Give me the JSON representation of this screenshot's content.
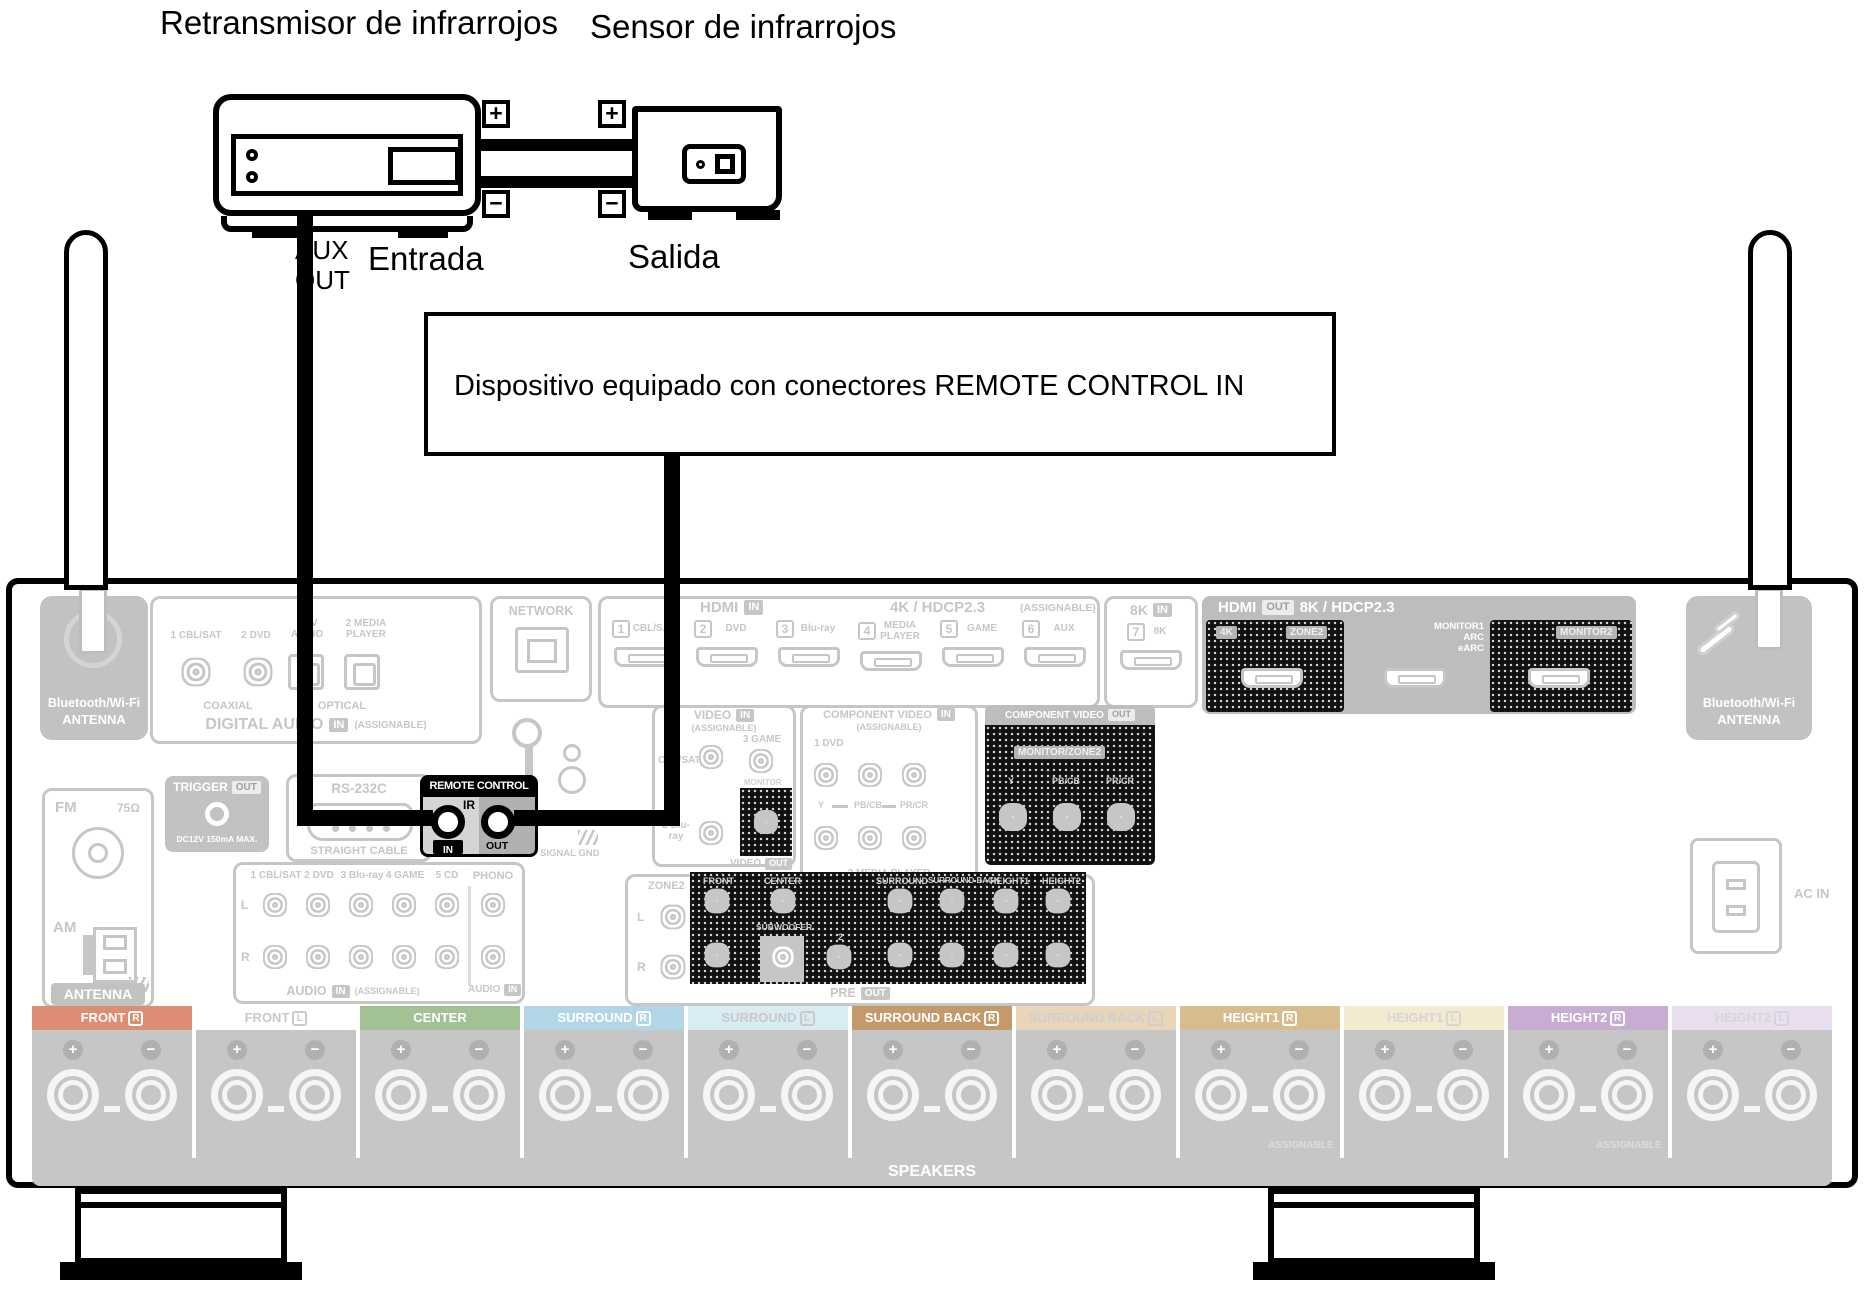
{
  "glyphs": {
    "plus": "+",
    "minus": "−"
  },
  "top": {
    "retransmitter_label": "Retransmisor de infrarrojos",
    "sensor_label": "Sensor de infrarrojos",
    "aux_line1": "AUX",
    "aux_line2": "OUT",
    "entrada": "Entrada",
    "salida": "Salida"
  },
  "device_box": {
    "text": "Dispositivo equipado con conectores REMOTE CONTROL IN"
  },
  "rear": {
    "bt_left": {
      "line1": "Bluetooth/Wi-Fi",
      "line2": "ANTENNA"
    },
    "bt_right": {
      "line1": "Bluetooth/Wi-Fi",
      "line2": "ANTENNA"
    },
    "digital_audio": {
      "p1": "1 CBL/SAT",
      "p2": "2 DVD",
      "p3": "1 TV AUDIO",
      "p4": "2 MEDIA PLAYER",
      "coaxial": "COAXIAL",
      "optical": "OPTICAL",
      "title": "DIGITAL AUDIO",
      "badge": "IN",
      "assignable": "(ASSIGNABLE)"
    },
    "network": {
      "title": "NETWORK"
    },
    "hdmi_in": {
      "title": "HDMI",
      "badge": "IN",
      "subtitle": "4K / HDCP2.3",
      "assignable": "(ASSIGNABLE)",
      "ports": [
        {
          "num": "1",
          "label": "CBL/SAT"
        },
        {
          "num": "2",
          "label": "DVD"
        },
        {
          "num": "3",
          "label": "Blu-ray"
        },
        {
          "num": "4",
          "label": "MEDIA PLAYER"
        },
        {
          "num": "5",
          "label": "GAME"
        },
        {
          "num": "6",
          "label": "AUX"
        }
      ],
      "port7": {
        "title": "8K",
        "badge": "IN",
        "num": "7",
        "label": "8K"
      }
    },
    "hdmi_out": {
      "title": "HDMI",
      "badge": "OUT",
      "subtitle": "8K / HDCP2.3",
      "out1_label1": "4K",
      "out1_label2": "ZONE2",
      "out2_line1": "MONITOR1",
      "out2_line2": "ARC",
      "out2_line3": "eARC",
      "out3_label": "MONITOR2"
    },
    "fm_am": {
      "fm": "FM",
      "ohm": "75Ω",
      "am": "AM",
      "antenna": "ANTENNA"
    },
    "trigger": {
      "title": "TRIGGER",
      "badge": "OUT",
      "note": "DC12V 150mA MAX."
    },
    "rs232": {
      "title": "RS-232C",
      "note": "STRAIGHT CABLE"
    },
    "remote": {
      "title": "REMOTE CONTROL",
      "ir": "IR",
      "in_label": "IN",
      "out_label": "OUT"
    },
    "signal_gnd": {
      "label": "SIGNAL GND"
    },
    "audio": {
      "p1": "1 CBL/SAT",
      "p2": "2 DVD",
      "p3": "3 Blu-ray",
      "p4": "4 GAME",
      "p5": "5 CD",
      "phono": "PHONO",
      "l": "L",
      "r": "R",
      "title": "AUDIO",
      "badge": "IN",
      "assignable": "(ASSIGNABLE)",
      "phono_title": "AUDIO",
      "phono_badge": "IN"
    },
    "video": {
      "title": "VIDEO",
      "badge": "IN",
      "assignable": "(ASSIGNABLE)",
      "p1": "1 CBL/SAT",
      "p2": "2 Blu-ray",
      "p3": "3 GAME",
      "monitor": "MONITOR",
      "out_title": "VIDEO",
      "out_badge": "OUT"
    },
    "component_in": {
      "title": "COMPONENT VIDEO",
      "badge": "IN",
      "assignable": "(ASSIGNABLE)",
      "p1": "1 DVD",
      "y": "Y",
      "pb": "PB/CB",
      "pr": "PR/CR",
      "p2": "2 MEDIA PLAYER"
    },
    "component_out": {
      "title": "COMPONENT VIDEO",
      "badge": "OUT",
      "monitor": "MONITOR/ZONE2",
      "y": "Y",
      "pb": "PB/CB",
      "pr": "PR/CR"
    },
    "zone2": {
      "title": "ZONE2",
      "l": "L",
      "r": "R"
    },
    "preout": {
      "c1": "FRONT",
      "c2": "CENTER",
      "sub": "SUBWOOFER",
      "sub1": "1",
      "sub2": "2",
      "c3": "SURROUND",
      "c4": "SURROUND BACK",
      "c5": "HEIGHT1",
      "c6": "HEIGHT2",
      "title": "PRE",
      "badge": "OUT"
    },
    "ac_in": {
      "label": "AC IN"
    },
    "speakers": {
      "title": "SPEAKERS",
      "assignable": "ASSIGNABLE",
      "blocks": [
        {
          "label": "FRONT",
          "ch": "R",
          "color": "#de8d75",
          "fg": "#ffffff"
        },
        {
          "label": "FRONT",
          "ch": "L",
          "color": "#ffffff",
          "fg": "#c9c9c9"
        },
        {
          "label": "CENTER",
          "color": "#a3c293",
          "fg": "#ffffff"
        },
        {
          "label": "SURROUND",
          "ch": "R",
          "color": "#b3d6e7",
          "fg": "#ffffff"
        },
        {
          "label": "SURROUND",
          "ch": "L",
          "color": "#d9ebf3",
          "fg": "#c9c9c9"
        },
        {
          "label": "SURROUND BACK",
          "ch": "R",
          "color": "#c59a6b",
          "fg": "#ffffff"
        },
        {
          "label": "SURROUND BACK",
          "ch": "L",
          "color": "#e9d6b9",
          "fg": "#cfcfcf"
        },
        {
          "label": "HEIGHT1",
          "ch": "R",
          "color": "#d9bc8d",
          "fg": "#ffffff"
        },
        {
          "label": "HEIGHT1",
          "ch": "L",
          "color": "#f4ead0",
          "fg": "#d6d6d6"
        },
        {
          "label": "HEIGHT2",
          "ch": "R",
          "color": "#c7add2",
          "fg": "#ffffff"
        },
        {
          "label": "HEIGHT2",
          "ch": "L",
          "color": "#e9dff0",
          "fg": "#d6d6d6"
        }
      ]
    }
  },
  "colors": {
    "panel_line": "#c6c6c6",
    "panel_fill": "#c2c2c2",
    "highlight": "#111111",
    "cable": "#000000"
  }
}
